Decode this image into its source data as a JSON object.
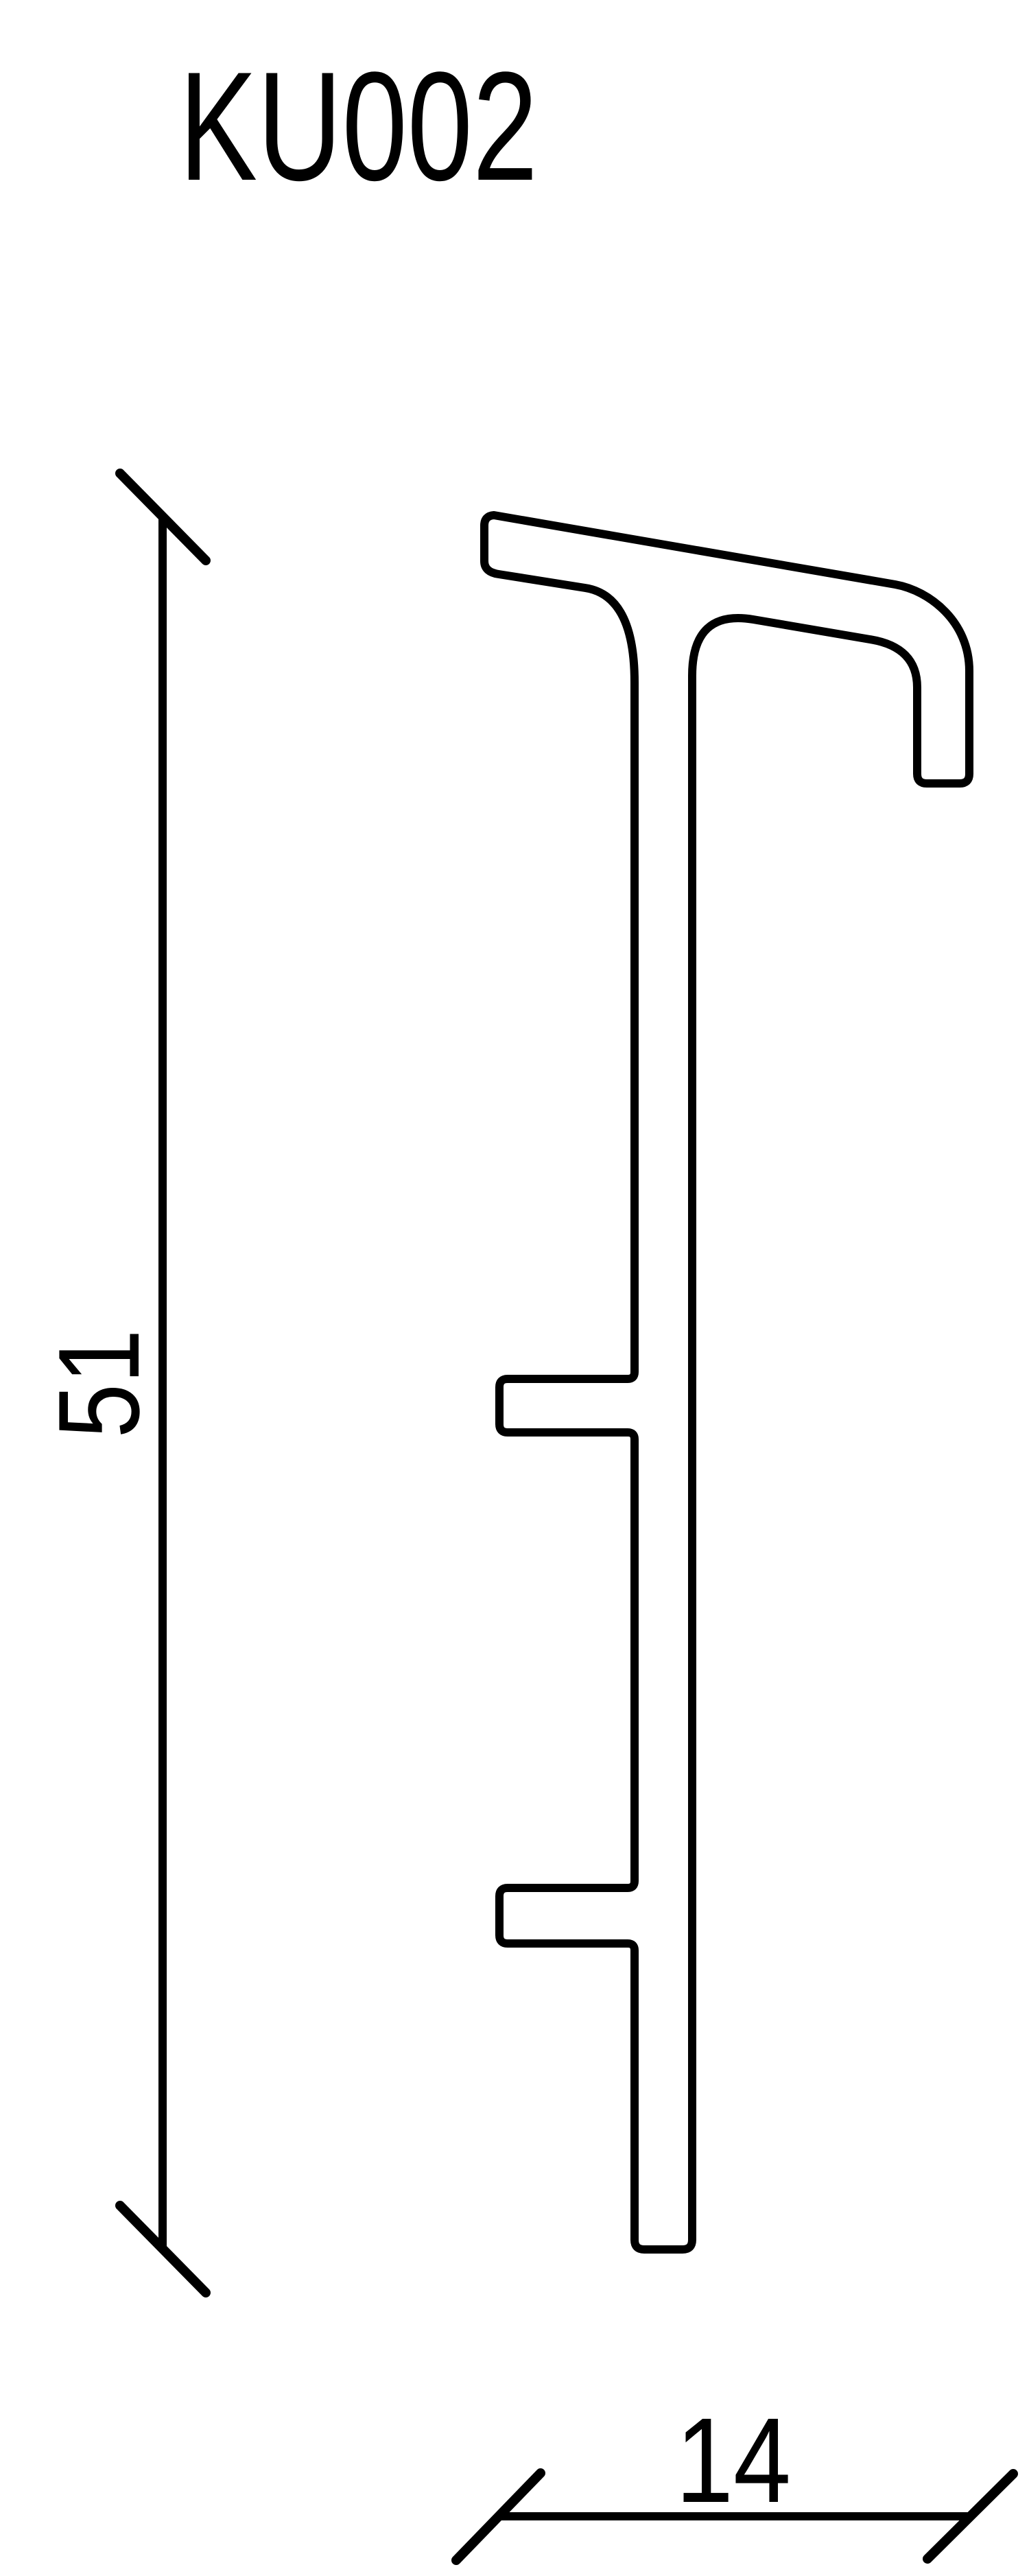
{
  "page": {
    "title": "KU002",
    "background_color": "#ffffff",
    "ink_color": "#000000"
  },
  "profile": {
    "outline_path": "M 720 751 L 1305 852 C 1355 861 1413 906 1413 978 L 1413 1128 Q 1413 1142 1399 1142 L 1351 1142 Q 1337 1142 1337 1128 L 1337 1002 Q 1337 943 1268 932 L 1098 903 Q 1009 888 1009 985 L 1009 3265 Q 1009 3279 995 3279 L 939 3279 Q 925 3279 925 3265 L 925 2843 Q 925 2833 915 2833 L 740 2833 Q 728 2833 728 2821 L 728 2764 Q 728 2752 740 2752 L 915 2752 Q 925 2752 925 2742 L 925 2098 Q 925 2088 915 2088 L 740 2088 Q 728 2088 728 2076 L 728 2022 Q 728 2010 740 2010 L 915 2010 Q 925 2010 925 2000 L 925 995 Q 925 868 853 857 L 727 837 Q 706 834 706 818 L 706 766 Q 706 752 720 751 Z"
  },
  "dimensions": {
    "height": {
      "value": "51",
      "line_path": "M 237 753 L 237 3277",
      "tick_top_path": "M 175 690 L 300 817",
      "tick_bottom_path": "M 175 3215 L 300 3342"
    },
    "depth": {
      "value": "14",
      "line_path": "M 725 3668 L 1415 3668",
      "tick_left_path": "M 665 3732 L 788 3605",
      "tick_right_path": "M 1352 3730 L 1477 3606"
    }
  }
}
